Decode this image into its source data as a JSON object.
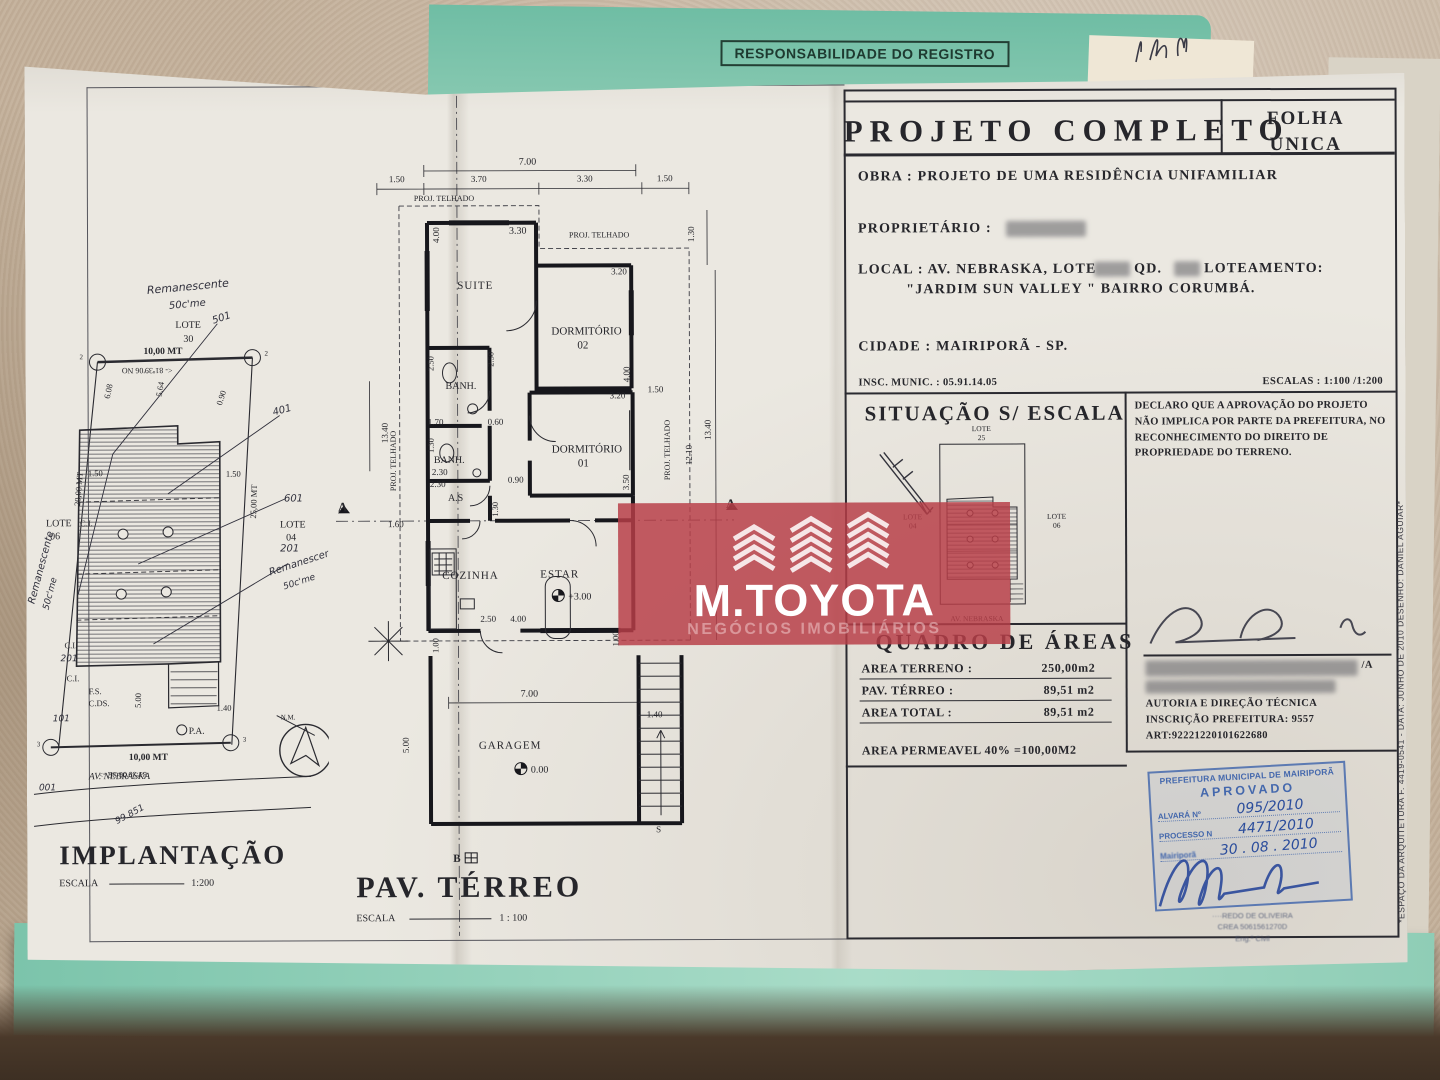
{
  "scene": {
    "folder_stamp": "RESPONSABILIDADE DO REGISTRO"
  },
  "watermark": {
    "brand": "M.TOYOTA",
    "tagline": "NEGÓCIOS IMOBILIÁRIOS",
    "accent_color": "#b83e48"
  },
  "titleblock": {
    "title": "PROJETO  COMPLETO",
    "folha1": "FOLHA",
    "folha2": "ÚNICA",
    "obra": "OBRA :  PROJETO  DE  UMA  RESIDÊNCIA  UNIFAMILIAR",
    "proprietario": "PROPRIETÁRIO :",
    "local1": "LOCAL :  AV.  NEBRASKA,  LOTE",
    "local1b": "QD.",
    "local1c": "LOTEAMENTO:",
    "local2": "\"JARDIM  SUN  VALLEY \"  BAIRRO  CORUMBÁ.",
    "cidade": "CIDADE :    MAIRIPORÃ  -  SP.",
    "insc": "INSC. MUNIC. : 05.91.14.05",
    "escalas": "ESCALAS :  1:100 /1:200",
    "situacao_title": "SITUAÇÃO  S/  ESCALA",
    "declaro": "DECLARO QUE A APROVAÇÃO DO PROJETO NÃO IMPLICA POR PARTE DA PREFEITURA, NO RECONHECIMENTO DO DIREITO DE PROPRIEDADE DO TERRENO.",
    "sig_suffix": "/A",
    "autoria1": "AUTORIA E DIREÇÃO TÉCNICA",
    "autoria2": "INSCRIÇÃO PREFEITURA: 9557",
    "autoria3": "ART:92221220101622680",
    "quadro": {
      "title": "QUADRO  DE  ÁREAS",
      "t1": "AREA TERRENO :",
      "v1": "250,00m2",
      "t2": "PAV. TÉRREO :",
      "v2": "89,51 m2",
      "t3": "AREA TOTAL :",
      "v3": "89,51 m2",
      "perm": "AREA PERMEAVEL 40% =100,00M2"
    },
    "margin_note": "*ESPAÇO DA ARQUITETURA F. 4419-0541  -  DATA: JUNHO DE 2010  DESENHO: DANIEL AGUIAR*"
  },
  "sit": {
    "lote": "LOTE",
    "n25": "25",
    "n04": "04",
    "n06": "06",
    "street": "AV.  NEBRASKA"
  },
  "stamp": {
    "line1": "PREFEITURA MUNICIPAL DE MAIRIPORÃ",
    "line2": "APROVADO",
    "alvara_label": "ALVARÁ Nº",
    "alvara_value": "095/2010",
    "processo_label": "PROCESSO N",
    "processo_value": "4471/2010",
    "date_label": "Mairiporã",
    "date_value": "30 . 08 . 2010",
    "name": "····REDO DE OLIVEIRA",
    "crea": "CREA 5061561270D",
    "role": "Eng.º Civil"
  },
  "imp": {
    "title": "IMPLANTAÇÃO",
    "esc": "ESCALA",
    "escv": "1:200",
    "remA": "Remanescente",
    "remB": "50c'me",
    "lote": "LOTE",
    "n30": "30",
    "n06": "06",
    "n04": "04",
    "h501": "501",
    "h401": "401",
    "h601": "601",
    "h201": "201",
    "h101": "101",
    "h001": "001",
    "h99": "99.851",
    "mt10": "10,00  MT",
    "mt20": "20,00 MT",
    "mt25": "25,00 MT",
    "d608": "6.08",
    "d564": "5.64",
    "d090": "0.90",
    "d150": "1.50",
    "d500": "5.00",
    "d140": "1.40",
    "ci": "C.I.",
    "fs": "F.S.",
    "cds": "C.DS.",
    "pa": "P.A.",
    "brgT": "<- 81º39'06  NO",
    "brgB": "81º39'06  SE ->",
    "street": "AV.  NEBRASKA",
    "nm": "N.M.",
    "p2": "2",
    "p3": "3"
  },
  "plan": {
    "title": "PAV.  TÉRREO",
    "esc": "ESCALA",
    "escv": "1 : 100",
    "rooms": {
      "suite": "SUITE",
      "dorm": "DORMITÓRIO",
      "n02": "02",
      "n01": "01",
      "banh": "BANH.",
      "as": "A.S",
      "coz": "COZINHA",
      "estar": "ESTAR",
      "gar": "GARAGEM"
    },
    "d": {
      "top7": "7.00",
      "a150": "1.50",
      "a370": "3.70",
      "a330": "3.30",
      "pt": "PROJ. TELHADO",
      "s400": "4.00",
      "s330": "3.30",
      "d2w": "3.20",
      "r130": "1.30",
      "c250": "2.50",
      "b170": "1.70",
      "b060": "0.60",
      "b130": "1.30",
      "b230": "2.30",
      "as090": "0.90",
      "as130": "1.30",
      "d1w": "3.20",
      "d1t": "4.00",
      "d1h": "3.50",
      "rt150": "1.50",
      "r1210": "12.10",
      "r1340": "13.40",
      "cut160": "1.60",
      "k250": "2.50",
      "k400": "4.00",
      "v100": "1.00",
      "g700": "7.00",
      "g500": "5.00",
      "st140": "1.40",
      "sS": "S",
      "mA": "A",
      "mB": "B",
      "lvE": "+3.00",
      "lvG": "0.00"
    }
  }
}
